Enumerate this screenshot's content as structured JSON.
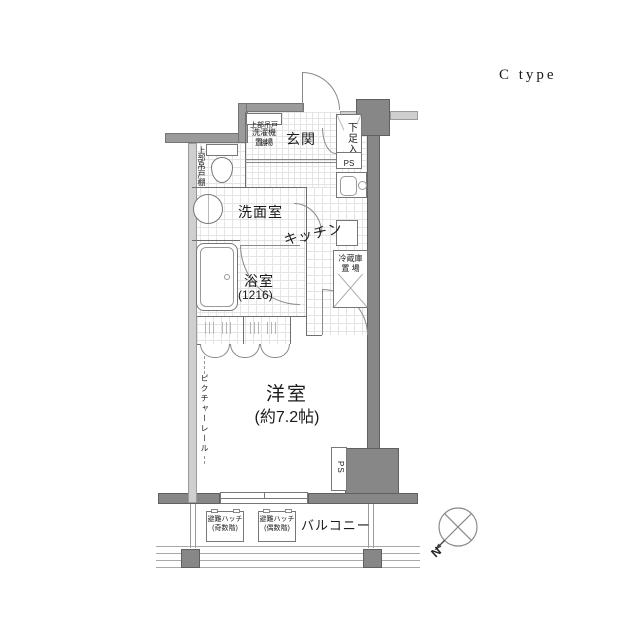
{
  "title": "C type",
  "colors": {
    "wall": "#9b9b9b",
    "wall_dark": "#878787",
    "wall_light": "#cfcfcf",
    "line": "#777777",
    "text": "#1a1a1a"
  },
  "floor_plan": {
    "entrance": {
      "label": "玄関",
      "shoe_cabinet": "下足入",
      "pipe_space": "PS"
    },
    "storage": {
      "upper_cabinet_top": "上部吊戸棚",
      "upper_cabinet_left": "上部吊戸棚",
      "washing_machine": "洗濯機\n置 場"
    },
    "washroom": {
      "label": "洗面室"
    },
    "bathroom": {
      "label": "浴室",
      "size": "(1216)"
    },
    "kitchen": {
      "label": "キッチン",
      "fridge_space": "冷蔵庫\n置 場"
    },
    "main_room": {
      "label": "洋室",
      "size": "(約7.2帖)",
      "picture_rail": "ピクチャーレール",
      "pipe_space": "PS"
    },
    "balcony": {
      "label": "バルコニー",
      "hatch_odd": "避難ハッチ\n(奇数階)",
      "hatch_even": "避難ハッチ\n(偶数階)"
    },
    "compass": {
      "north": "N"
    }
  }
}
